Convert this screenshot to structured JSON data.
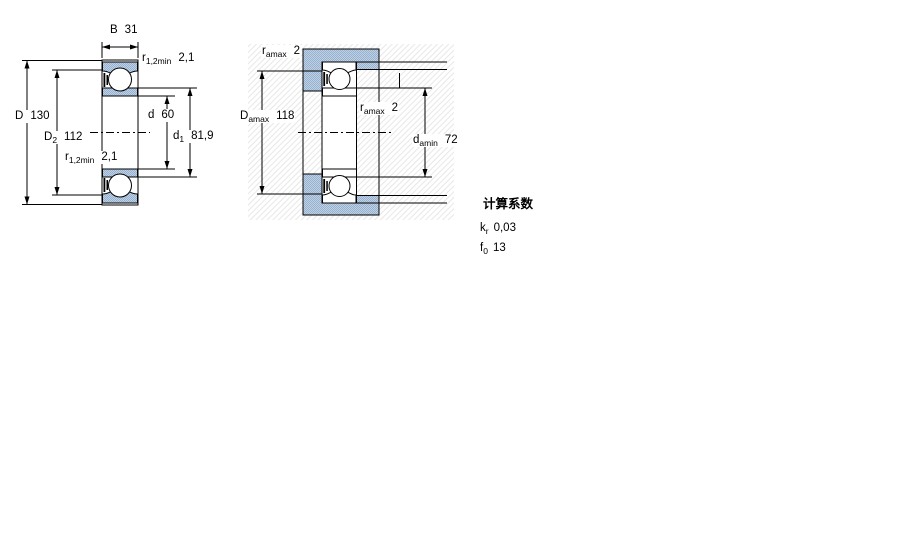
{
  "fig1": {
    "labels": {
      "B": {
        "sym": "B",
        "val": "31"
      },
      "r_top": {
        "sym": "r",
        "sub": "1,2min",
        "val": "2,1"
      },
      "D": {
        "sym": "D",
        "val": "130"
      },
      "D2": {
        "sym": "D",
        "sub": "2",
        "val": "112"
      },
      "d": {
        "sym": "d",
        "val": "60"
      },
      "d1": {
        "sym": "d",
        "sub": "1",
        "val": "81,9"
      },
      "r_bot": {
        "sym": "r",
        "sub": "1,2min",
        "val": "2,1"
      }
    }
  },
  "fig2": {
    "labels": {
      "r_top": {
        "sym": "r",
        "sub": "amax",
        "val": "2"
      },
      "Damax": {
        "sym": "D",
        "sub": "amax",
        "val": "118"
      },
      "r_mid": {
        "sym": "r",
        "sub": "amax",
        "val": "2"
      },
      "damin": {
        "sym": "d",
        "sub": "amin",
        "val": "72"
      }
    }
  },
  "factors": {
    "title": "计算系数",
    "items": [
      {
        "sym": "k",
        "sub": "r",
        "val": "0,03"
      },
      {
        "sym": "f",
        "sub": "0",
        "val": "13"
      }
    ]
  },
  "colors": {
    "bearing_fill": "#aac0da",
    "bearing_fill_dot": "#97b1d1",
    "line": "#000000"
  }
}
